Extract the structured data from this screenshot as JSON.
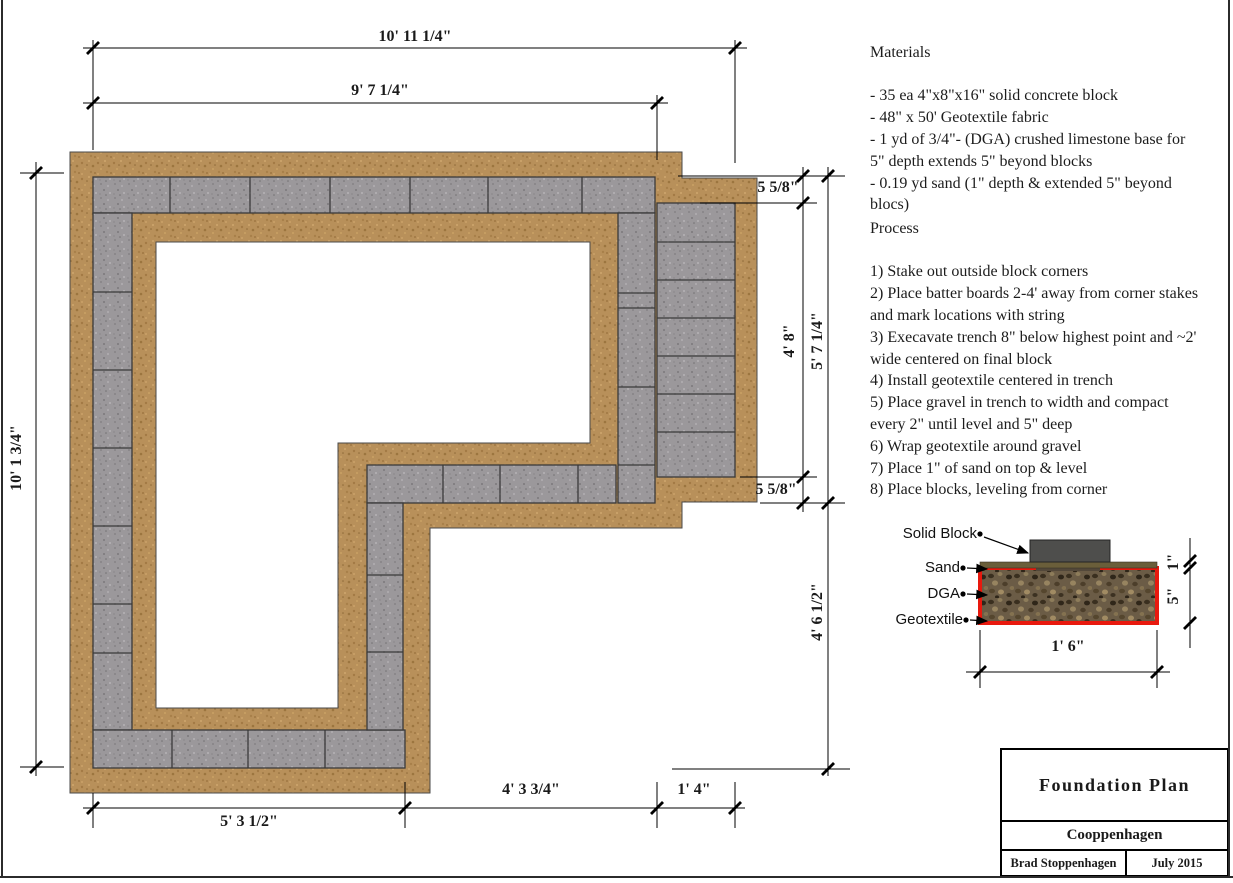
{
  "materials": {
    "title": "Materials",
    "items": [
      "- 35 ea 4\"x8\"x16\" solid concrete block",
      "- 48\" x 50' Geotextile fabric",
      "- 1 yd of 3/4\"- (DGA) crushed limestone base for 5\" depth extends 5\" beyond blocks",
      "- 0.19 yd sand (1\" depth & extended 5\" beyond blocs)"
    ]
  },
  "process": {
    "title": "Process",
    "steps": [
      "1) Stake out outside block corners",
      "2) Place batter boards 2-4' away from corner stakes and mark locations with string",
      "3) Execavate trench 8\" below highest point and ~2' wide centered on final block",
      "4) Install geotextile centered in trench",
      "5) Place gravel in trench to width and compact every 2\" until level and 5\" deep",
      "6) Wrap geotextile around gravel",
      "7) Place 1\" of sand on top & level",
      "8) Place blocks, leveling from corner"
    ]
  },
  "plan_dimensions": {
    "top_overall": "10' 11 1/4\"",
    "top_to_step": "9' 7 1/4\"",
    "left_overall": "10' 1 3/4\"",
    "right_top_offset": "5 5/8\"",
    "right_block_run": "4' 8\"",
    "right_wing_depth": "5' 7 1/4\"",
    "right_bottom_offset": "5 5/8\"",
    "right_lower_clear": "4' 6 1/2\"",
    "bottom_left_wing": "5' 3 1/2\"",
    "bottom_clear": "4' 3 3/4\"",
    "bottom_block_width": "1' 4\""
  },
  "section": {
    "labels": {
      "block": "Solid Block",
      "sand": "Sand",
      "dga": "DGA",
      "geotextile": "Geotextile"
    },
    "dimensions": {
      "sand_depth": "1\"",
      "gravel_depth": "5\"",
      "width": "1' 6\""
    }
  },
  "title_block": {
    "drawing_title": "Foundation Plan",
    "project": "Cooppenhagen",
    "author": "Brad Stoppenhagen",
    "date": "July 2015"
  },
  "colors": {
    "gravel": "#b8905a",
    "block_gray": "#9b989b",
    "geotextile_red": "#e8190e",
    "sand_brown": "#6a5e3a",
    "solid_block_dark": "#4e4e4c"
  }
}
